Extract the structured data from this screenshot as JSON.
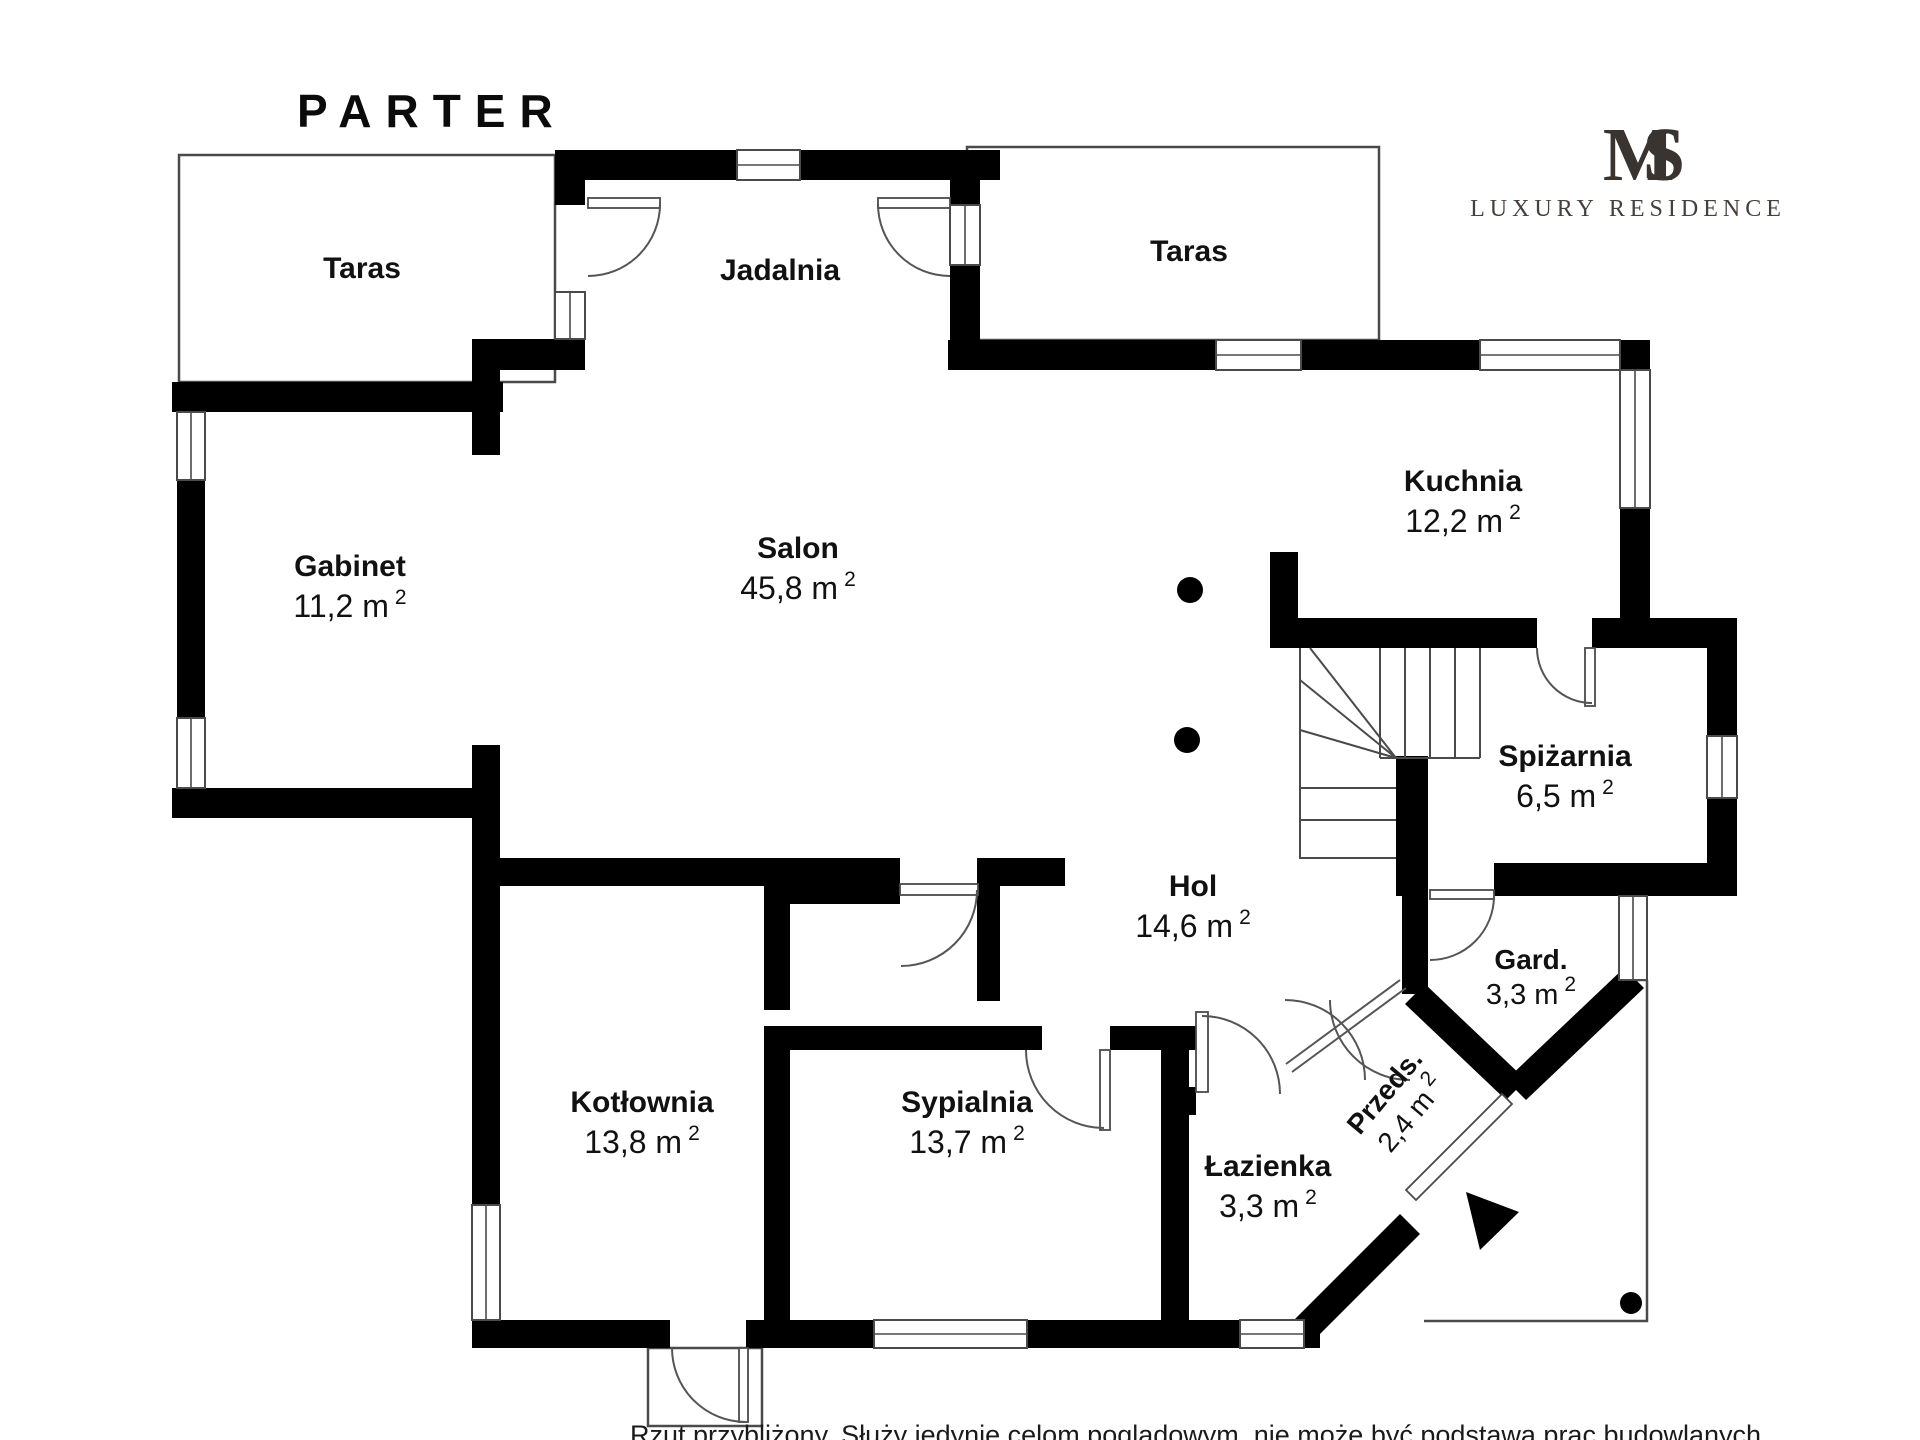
{
  "title": "PARTER",
  "logo": {
    "monogram": "MS",
    "brand": "LUXURY RESIDENCE"
  },
  "disclaimer": "Rzut przybliżony. Służy jedynie celom poglądowym, nie może być podstawą prac budowlanych",
  "units": {
    "sup": "2"
  },
  "colors": {
    "wall": "#000000",
    "line": "#4a4a4a",
    "text": "#111111",
    "logo": "#3a3430"
  },
  "rooms": [
    {
      "name": "Taras",
      "area": ""
    },
    {
      "name": "Jadalnia",
      "area": ""
    },
    {
      "name": "Taras",
      "area": ""
    },
    {
      "name": "Gabinet",
      "area": "11,2 m"
    },
    {
      "name": "Salon",
      "area": "45,8 m"
    },
    {
      "name": "Kuchnia",
      "area": "12,2 m"
    },
    {
      "name": "Spiżarnia",
      "area": "6,5 m"
    },
    {
      "name": "Hol",
      "area": "14,6 m"
    },
    {
      "name": "Gard.",
      "area": "3,3 m"
    },
    {
      "name": "Przeds.",
      "area": "2,4 m"
    },
    {
      "name": "Łazienka",
      "area": "3,3 m"
    },
    {
      "name": "Sypialnia",
      "area": "13,7 m"
    },
    {
      "name": "Kotłownia",
      "area": "13,8 m"
    }
  ]
}
